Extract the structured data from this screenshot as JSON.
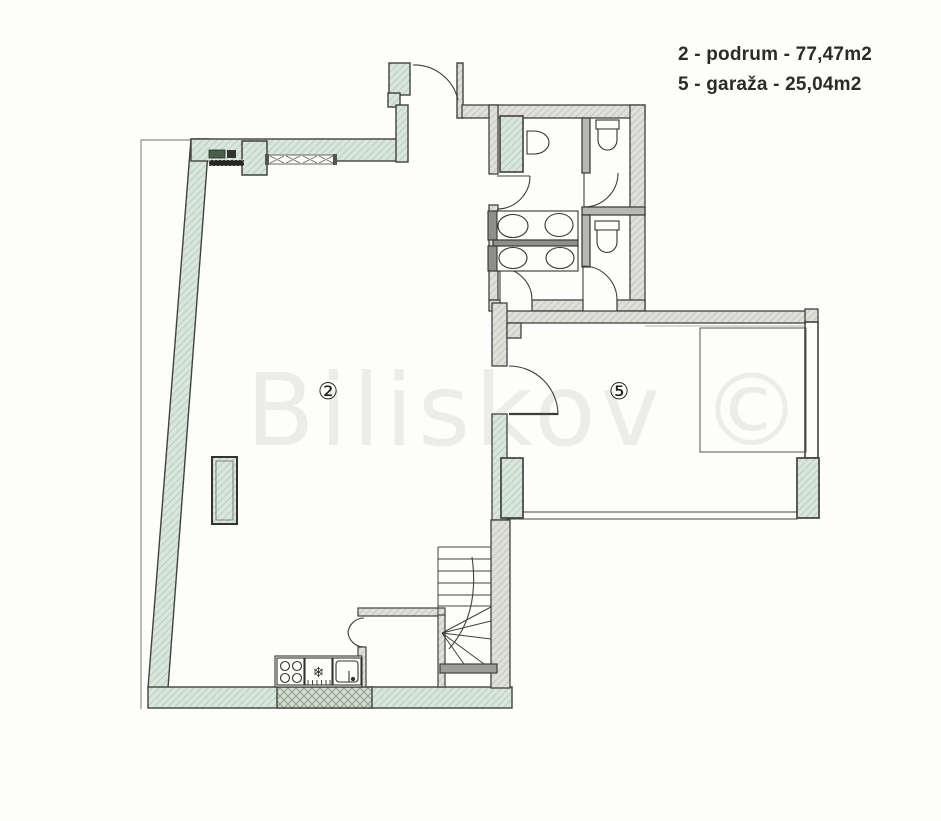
{
  "legend": {
    "items": [
      {
        "text": "2 - podrum - 77,47m2"
      },
      {
        "text": "5 - garaža - 25,04m2"
      }
    ]
  },
  "watermark": {
    "text": "Biliskov ©"
  },
  "rooms": {
    "room2": {
      "label": "②"
    },
    "room5": {
      "label": "⑤"
    }
  },
  "symbols": {
    "freezer": "❄"
  },
  "colors": {
    "wall_green": "#d9e6db",
    "wall_green_hatch": "#b9cfc0",
    "wall_gray": "#e0e0da",
    "wall_dark": "#8f8f89",
    "outline": "#42423c",
    "watermark_gray": "#ececea"
  }
}
